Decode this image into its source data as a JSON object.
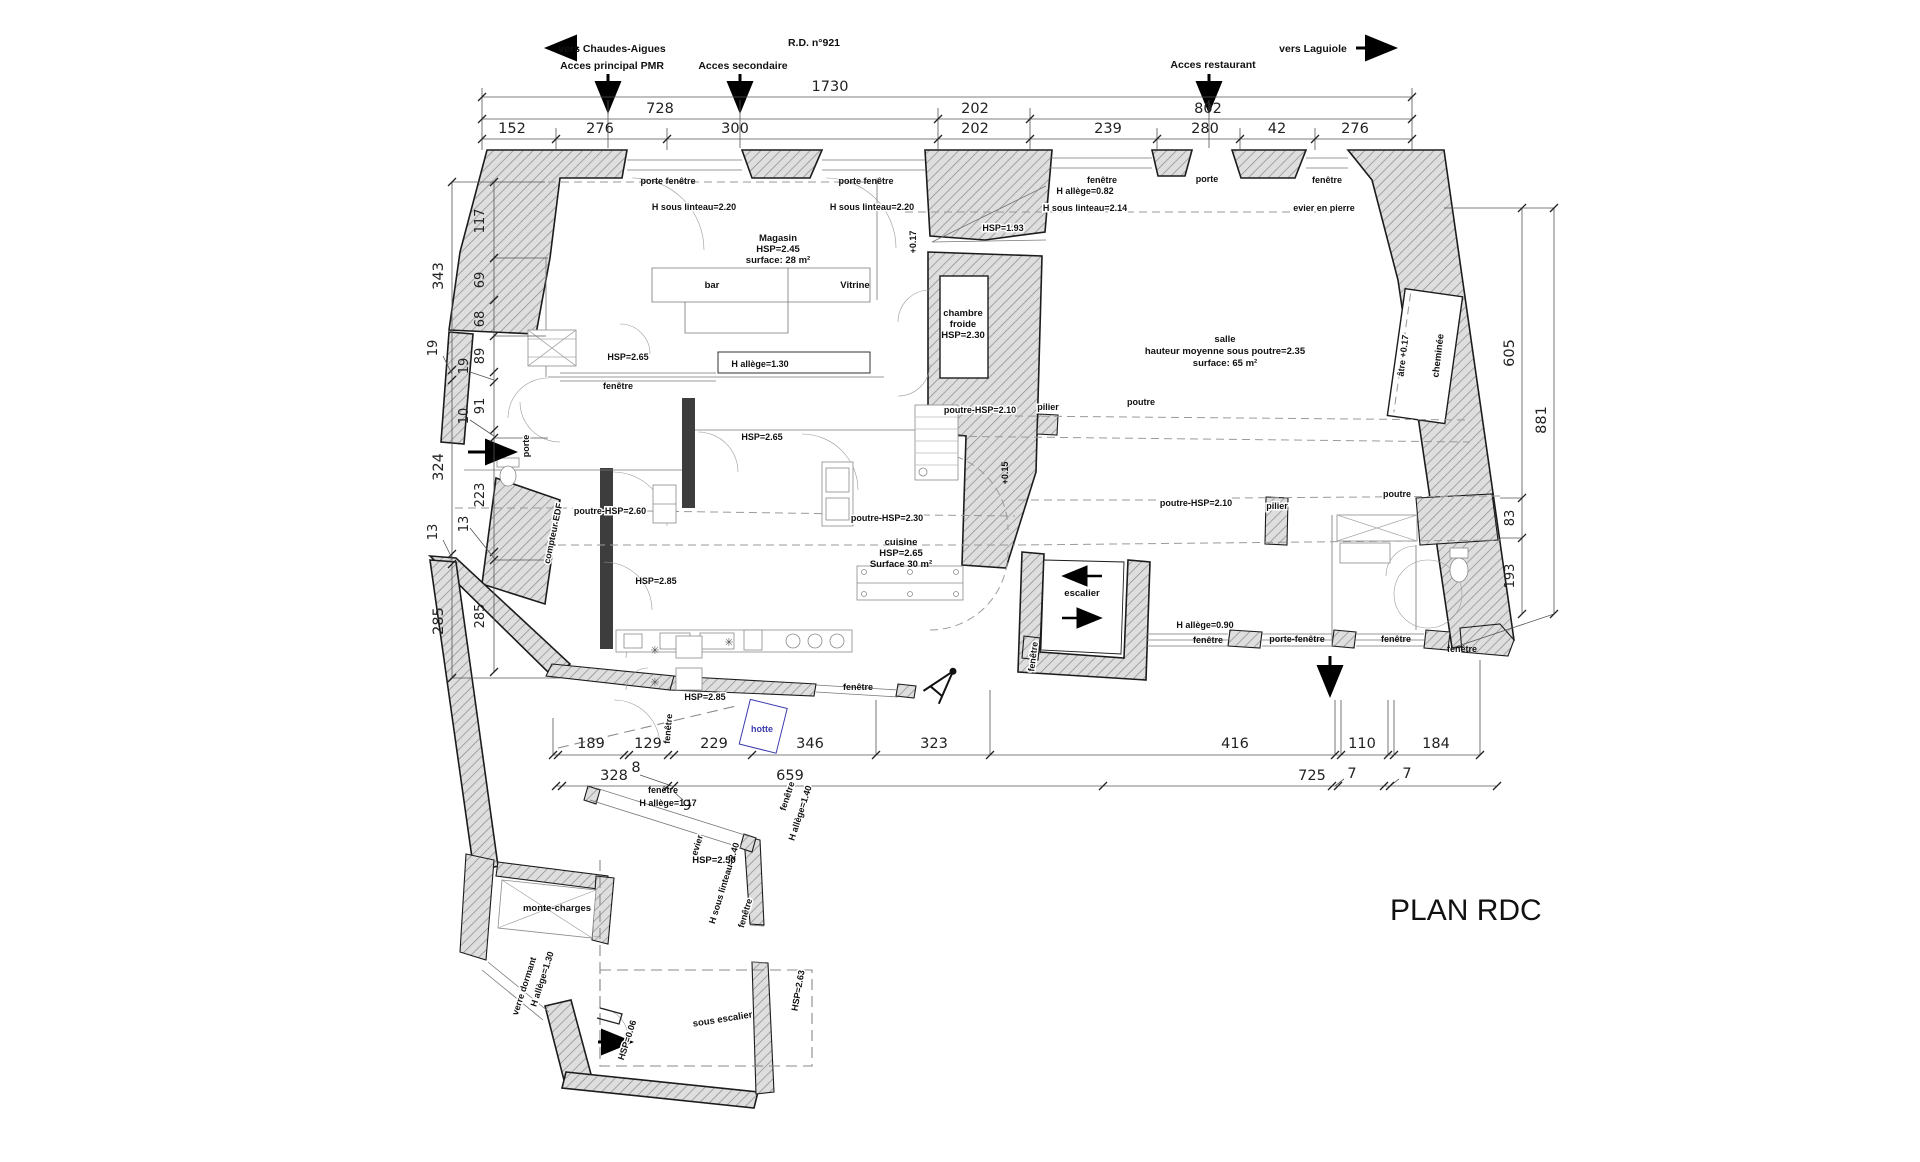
{
  "plan": {
    "title": "PLAN RDC"
  },
  "access": {
    "chaudes": "vers Chaudes-Aigues",
    "pmr": "Acces principal PMR",
    "secondaire": "Acces secondaire",
    "road": "R.D. n°921",
    "restaurant": "Acces restaurant",
    "laguiole": "vers Laguiole"
  },
  "dims": {
    "t1": [
      "1730"
    ],
    "t2": [
      "728",
      "202",
      "802"
    ],
    "t3": [
      "152",
      "276",
      "300",
      "202",
      "239",
      "280",
      "42",
      "276"
    ],
    "lo": [
      "343",
      "19",
      "324",
      "13",
      "285"
    ],
    "li": [
      "117",
      "69",
      "68",
      "89",
      "19",
      "91",
      "10",
      "223",
      "13",
      "285"
    ],
    "ri": [
      "605",
      "83",
      "193"
    ],
    "ro": [
      "881"
    ],
    "b1": [
      "189",
      "129",
      "229",
      "346",
      "323",
      "416",
      "110",
      "184"
    ],
    "b2": [
      "328",
      "8",
      "659",
      "725",
      "7",
      "7"
    ],
    "b3": [
      "9"
    ]
  },
  "rooms": {
    "magasin": {
      "l1": "Magasin",
      "l2": "HSP=2.45",
      "l3": "surface: 28 m²"
    },
    "salle": {
      "l1": "salle",
      "l2": "hauteur moyenne sous poutre=2.35",
      "l3": "surface: 65 m²"
    },
    "cuisine": {
      "l1": "cuisine",
      "l2": "HSP=2.65",
      "l3": "Surface 30 m²"
    },
    "froide": {
      "l1": "chambre",
      "l2": "froide",
      "l3": "HSP=2.30"
    },
    "escalier": "escalier",
    "monte": "monte-charges",
    "sous_esc": "sous escalier",
    "bar": "bar",
    "vitrine": "Vitrine",
    "cheminee": "cheminée",
    "atre": "âtre +0.17"
  },
  "lbl": {
    "porte_fen": "porte fenêtre",
    "porte_fen_d": "porte-fenêtre",
    "lint220": "H sous linteau=2.20",
    "lint214": "H sous linteau=2.14",
    "lint240": "H sous linteau=2.40",
    "fenetre": "fenêtre",
    "porte": "porte",
    "evier": "evier",
    "evier_pierre": "evier en pierre",
    "hotte": "hotte",
    "compteur": "compteur EDF",
    "verre": "verre dormant",
    "al082": "H allège=0.82",
    "al090": "H allège=0.90",
    "al117": "H allège=1.17",
    "al130": "H allège=1.30",
    "al140": "H allège=1.40",
    "hsp193": "HSP=1.93",
    "hsp250": "HSP=2.50",
    "hsp263": "HSP=2.63",
    "hsp265": "HSP=2.65",
    "hsp285": "HSP=2.85",
    "hsp006": "HSP=0.06",
    "p260": "poutre-HSP=2.60",
    "p230": "poutre-HSP=2.30",
    "p210": "poutre-HSP=2.10",
    "poutre": "poutre",
    "pilier": "pilier",
    "lvl017": "+0.17",
    "lvl015": "+0.15"
  },
  "icons": {
    "fan": "✳"
  }
}
